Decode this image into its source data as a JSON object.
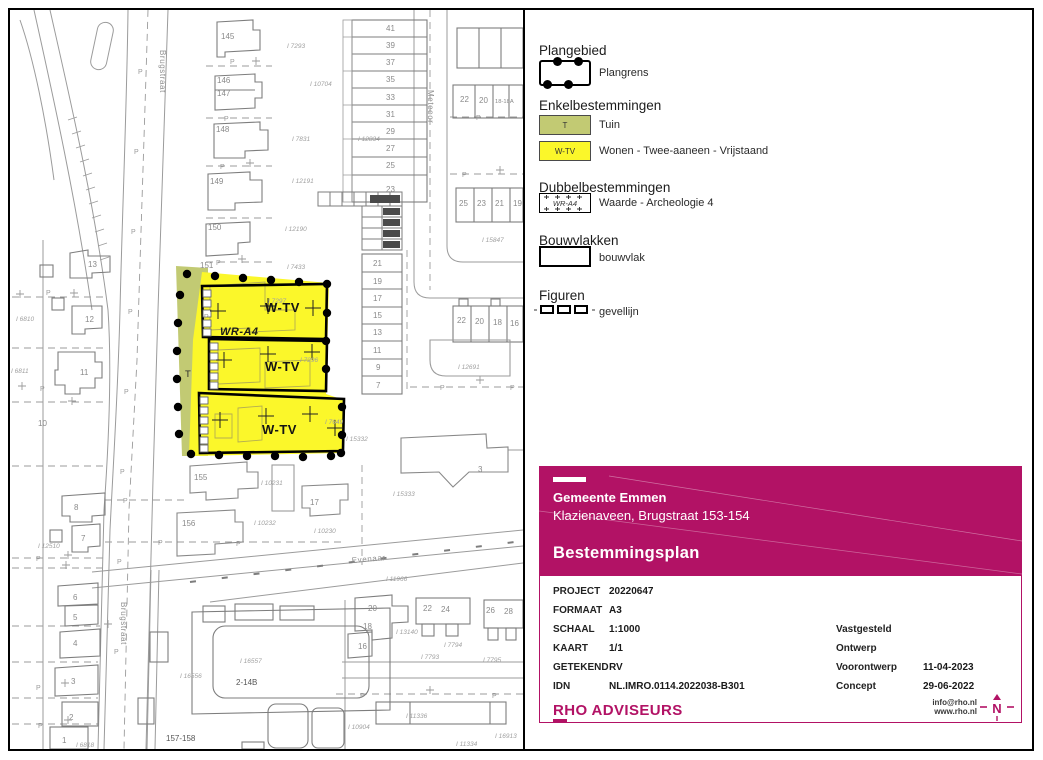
{
  "colors": {
    "accent_magenta": "#b21265",
    "zone_yellow": "#fbf72a",
    "zone_green": "#c2ca73",
    "line_gray": "#9b9b9b"
  },
  "legend": {
    "plangebied_title": "Plangebied",
    "plangrens_label": "Plangrens",
    "enkel_title": "Enkelbestemmingen",
    "t_code": "T",
    "t_label": "Tuin",
    "wtv_code": "W-TV",
    "wtv_label": "Wonen - Twee-aaneen - Vrijstaand",
    "dubbel_title": "Dubbelbestemmingen",
    "wra4_code": "WR-A4",
    "wra4_label": "Waarde - Archeologie 4",
    "bouw_title": "Bouwvlakken",
    "bouwvlak_label": "bouwvlak",
    "figuren_title": "Figuren",
    "gevellijn_label": "gevellijn"
  },
  "title_block": {
    "municipality": "Gemeente Emmen",
    "location": "Klazienaveen, Brugstraat 153-154",
    "plan_type": "Bestemmingsplan"
  },
  "project_info": {
    "rows": [
      {
        "label": "PROJECT",
        "value": "20220647"
      },
      {
        "label": "FORMAAT",
        "value": "A3"
      },
      {
        "label": "SCHAAL",
        "value": "1:1000"
      },
      {
        "label": "KAART",
        "value": "1/1"
      },
      {
        "label": "GETEKEND",
        "value": "RV"
      },
      {
        "label": "IDN",
        "value": "NL.IMRO.0114.2022038-B301"
      }
    ],
    "status_rows": [
      {
        "label": "Vastgesteld",
        "date": ""
      },
      {
        "label": "Ontwerp",
        "date": ""
      },
      {
        "label": "Voorontwerp",
        "date": "11-04-2023"
      },
      {
        "label": "Concept",
        "date": "29-06-2022"
      }
    ],
    "company": "RHO ADVISEURS",
    "email": "info@rho.nl",
    "website": "www.rho.nl",
    "north_letter": "N"
  },
  "map": {
    "streets": {
      "brugstraat": "Brugstraat",
      "meteoor": "Meteoor",
      "evenaar": "Evenaar"
    },
    "plan": {
      "wtv": "W-TV",
      "t": "T",
      "wra4": "WR-A4"
    },
    "marker": "P",
    "houses": [
      "145",
      "146",
      "147",
      "148",
      "149",
      "150",
      "151",
      "41",
      "39",
      "37",
      "35",
      "33",
      "31",
      "29",
      "27",
      "25",
      "23",
      "22",
      "20",
      "18-18A",
      "25",
      "23",
      "21",
      "19",
      "21",
      "19",
      "17",
      "15",
      "13",
      "11",
      "9",
      "7",
      "22",
      "20",
      "18",
      "16",
      "13",
      "12",
      "11",
      "10",
      "8",
      "7",
      "6",
      "5",
      "4",
      "3",
      "2",
      "1",
      "155",
      "156",
      "17",
      "3",
      "20",
      "18",
      "16",
      "22",
      "24",
      "26",
      "28",
      "2-14B",
      "157-158"
    ],
    "parcels": [
      "I 7293",
      "I 10704",
      "I 7831",
      "I 12191",
      "I 12190",
      "I 12834",
      "I 7433",
      "I 7297",
      "I 7296",
      "I 7649",
      "I 12691",
      "I 15847",
      "I 15332",
      "I 15333",
      "I 10231",
      "I 10232",
      "I 10230",
      "I 11966",
      "I 13140",
      "I 7793",
      "I 7794",
      "I 7795",
      "I 11336",
      "I 11334",
      "I 16913",
      "I 10904",
      "I 6810",
      "I 6811",
      "I 12510",
      "I 6818",
      "I 16556",
      "I 16557"
    ]
  }
}
